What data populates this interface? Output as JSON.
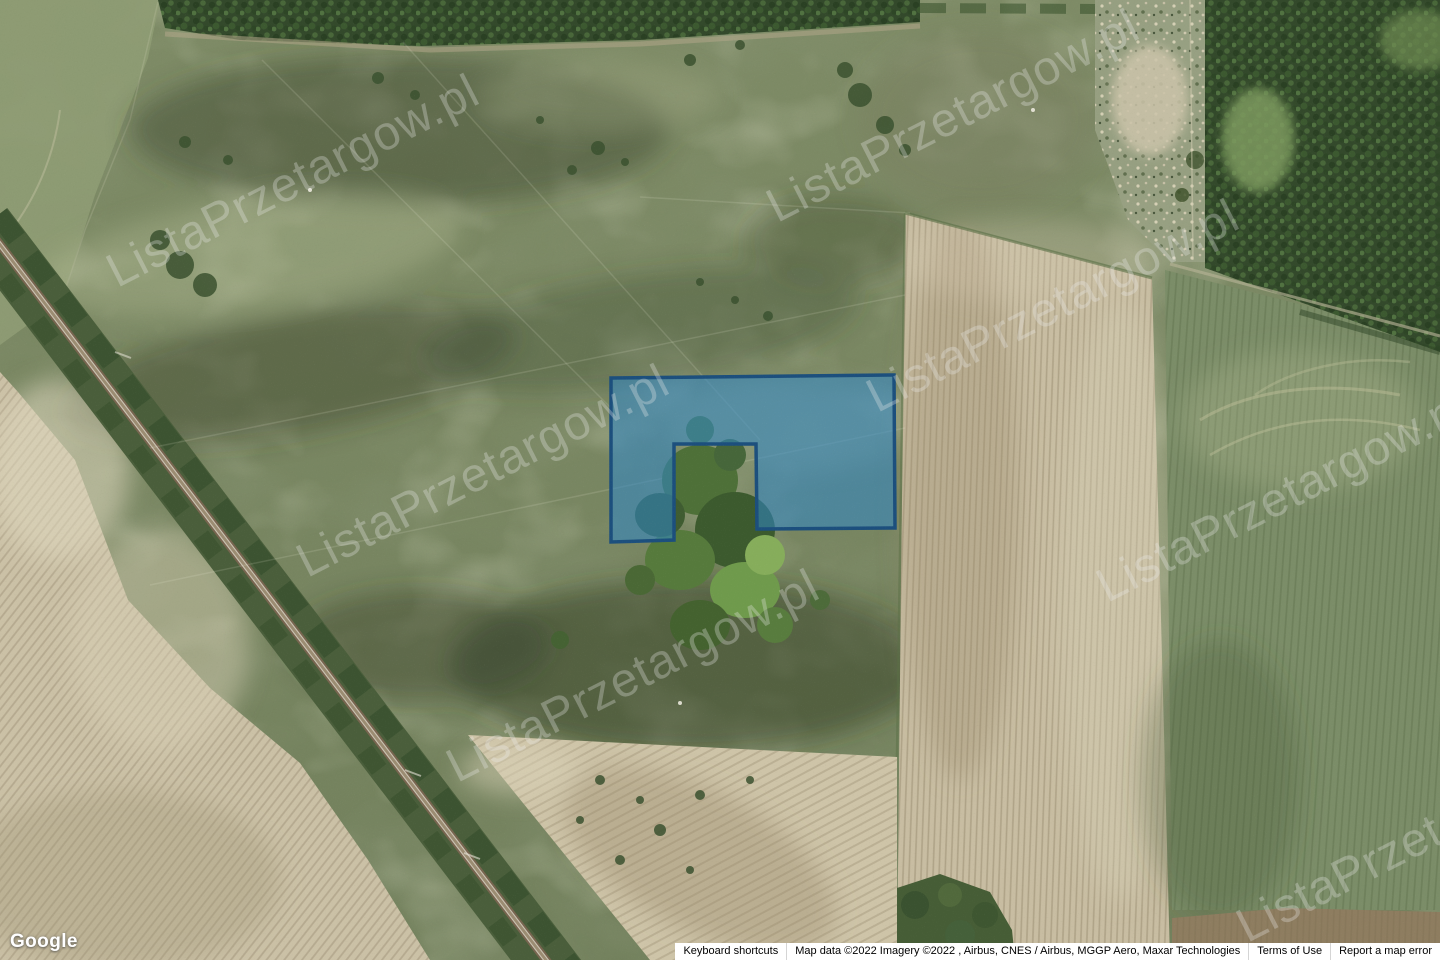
{
  "map": {
    "view_type": "satellite",
    "parcel_highlight": {
      "fill_color": "#2e86c8",
      "stroke_color": "#1c4f7d"
    }
  },
  "watermark": {
    "text": "ListaPrzetargow.pl"
  },
  "branding": {
    "google_logo": "Google"
  },
  "attribution": {
    "keyboard_shortcuts": "Keyboard shortcuts",
    "map_data": "Map data ©2022 Imagery ©2022 , Airbus, CNES / Airbus, MGGP Aero, Maxar Technologies",
    "terms_of_use": "Terms of Use",
    "report_error": "Report a map error"
  }
}
